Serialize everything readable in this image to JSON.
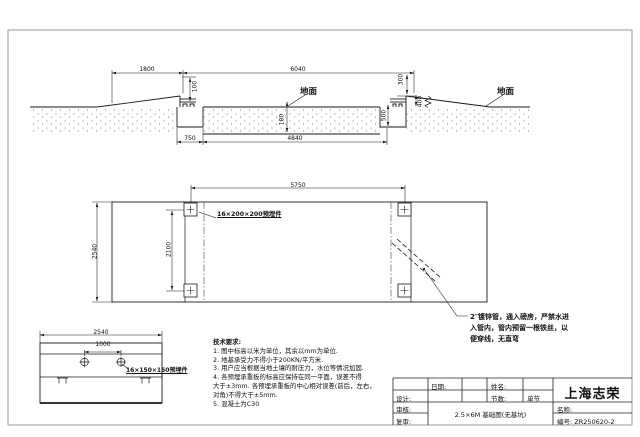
{
  "section": {
    "ground_label_mid": "地面",
    "ground_label_right": "地面",
    "dim_1800": "1800",
    "dim_6040": "6040",
    "dim_300": "300",
    "dim_100": "100",
    "dim_400": "400",
    "dim_500": "500",
    "dim_180": "180",
    "dim_750": "750",
    "dim_4840": "4840"
  },
  "plan": {
    "dim_5750": "5750",
    "dim_2540": "2540",
    "dim_2100": "2100",
    "plate_label": "16×200×200预埋件",
    "pipe_note": [
      "2″镀锌管，通入磅房，严禁水进",
      "入管内，管内预留一根铁丝，以",
      "便穿线，无直弯"
    ]
  },
  "detail": {
    "dim_2540": "2540",
    "dim_1000": "1000",
    "plate_label": "16×150×150预埋件"
  },
  "tech": {
    "lines": [
      "技术要求:",
      "1. 图中标高以米为单位，其余以mm为单位.",
      "2. 地基承受力不得小于200KN/平方米.",
      "3. 用户应当根据当地土壤的耐压力，水位等情况加固.",
      "4. 各预埋承重板的标高应保持在同一平面，误差不得",
      "大于±3mm. 各预埋承重板的中心相对误差(前后，左右，",
      "对角)不得大于±5mm.",
      "5. 混凝土为C30"
    ]
  },
  "titleblock": {
    "company": "上海志荣",
    "date_label": "日期:",
    "name_label": "姓名:",
    "design_label": "设计:",
    "sections_label": "节数:",
    "sections_value": "单节",
    "review_label": "审核:",
    "recheck_label": "复审:",
    "title_label": "名称:",
    "no_label": "编号:",
    "drawing_no": "ZR250620-2",
    "drawing_title": "2.5×6M 基础图(无基坑)"
  },
  "colors": {
    "line": "#1a1a1a",
    "border": "#999999"
  }
}
